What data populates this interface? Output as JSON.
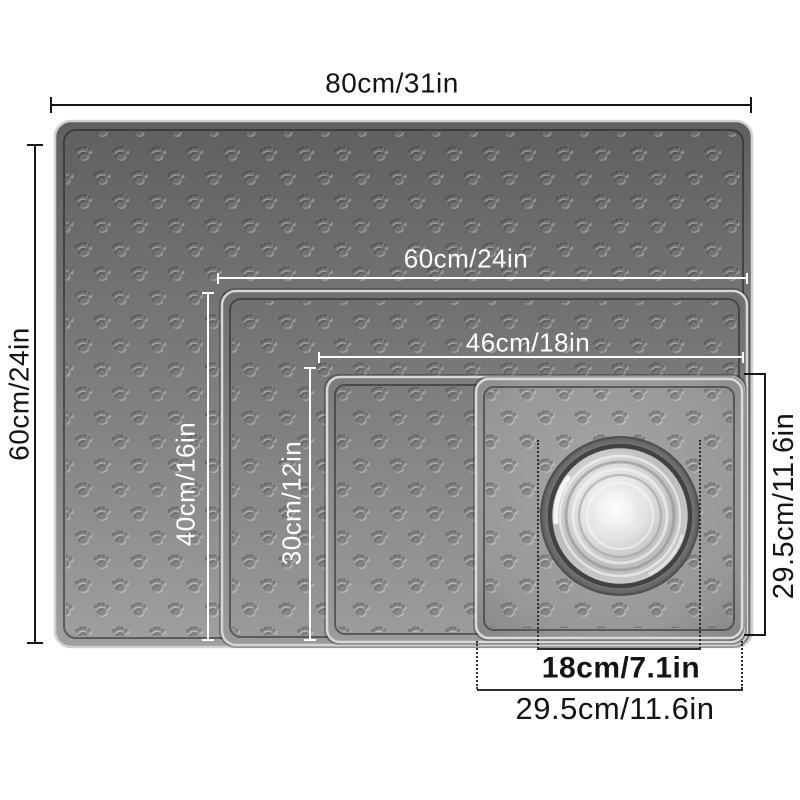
{
  "page": {
    "background": "#ffffff"
  },
  "product": {
    "kind": "pet-feeding-mat-size-chart",
    "texture": "paw-print-emboss",
    "mats": [
      {
        "id": "mat-largest",
        "width_label": "80cm/31in",
        "height_label": "60cm/24in"
      },
      {
        "id": "mat-large",
        "width_label": "60cm/24in",
        "height_label": "40cm/16in"
      },
      {
        "id": "mat-medium",
        "width_label": "46cm/18in",
        "height_label": "30cm/12in"
      },
      {
        "id": "mat-small",
        "width_label": "29.5cm/11.6in",
        "height_label": "29.5cm/11.6in"
      }
    ],
    "bowl": {
      "diameter_label": "18cm/7.1in"
    }
  },
  "colors": {
    "dimension_line_dark": "#161616",
    "dimension_line_white": "#ffffff",
    "mat_gray_dark": "#5f5f5f",
    "mat_gray_light": "#9f9f9f",
    "bowl_steel_light": "#f5f5f5",
    "bowl_steel_dark": "#424242"
  }
}
